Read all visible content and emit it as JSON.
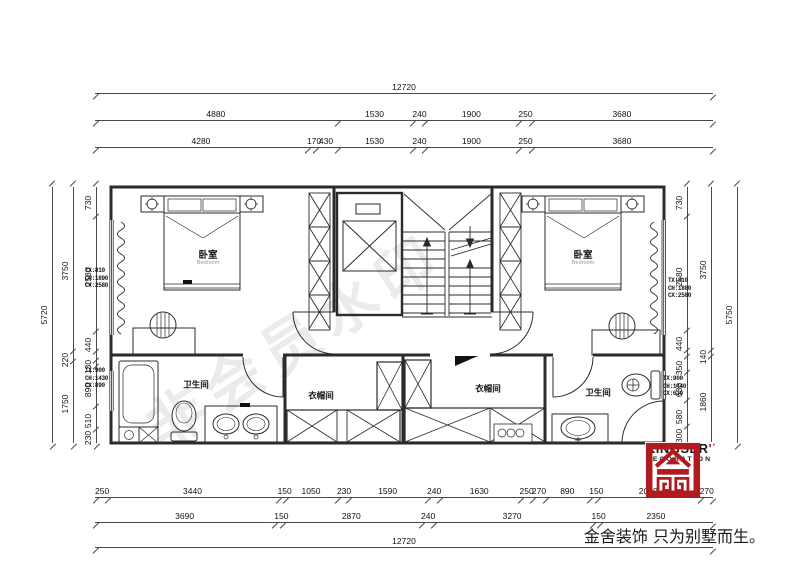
{
  "meta": {
    "watermark": "非会员水印",
    "accent_red": "#b01a20",
    "line_color": "#2b2b2b"
  },
  "brand": {
    "name": "KINGSER",
    "mark": "'",
    "sub": "DECORATION",
    "slogan": "金舍装饰 只为别墅而生。"
  },
  "rooms": {
    "bedroom_left": {
      "name": "卧室",
      "en": "Bedroom"
    },
    "bedroom_right": {
      "name": "卧室",
      "en": "Bedroom"
    },
    "bath_left": {
      "name": "卫生间"
    },
    "bath_right": {
      "name": "卫生间"
    },
    "closet_left": {
      "name": "衣帽间"
    },
    "closet_right": {
      "name": "衣帽间"
    }
  },
  "window_notes": {
    "left_top": [
      "TX:810",
      "CH:1890",
      "CX:2580"
    ],
    "left_bottom": [
      "TX:900",
      "CH:1430",
      "CX:890"
    ],
    "right_top": [
      "TX:810",
      "CH:1880",
      "CX:2580"
    ],
    "right_bottom": [
      "TX:900",
      "CH:1440",
      "CX:630"
    ]
  },
  "dimensions": {
    "top_overall": [
      {
        "v": 12720,
        "t": "12720"
      }
    ],
    "top_mid": [
      {
        "v": 4880,
        "t": "4880"
      },
      {
        "v": 1530,
        "t": "1530"
      },
      {
        "v": 240,
        "t": "240"
      },
      {
        "v": 1900,
        "t": "1900"
      },
      {
        "v": 250,
        "t": "250"
      },
      {
        "v": 3680,
        "t": "3680"
      }
    ],
    "top_inner": [
      {
        "v": 4280,
        "t": "4280"
      },
      {
        "v": 170,
        "t": "170"
      },
      {
        "v": 430,
        "t": "430"
      },
      {
        "v": 1530,
        "t": "1530"
      },
      {
        "v": 240,
        "t": "240"
      },
      {
        "v": 1900,
        "t": "1900"
      },
      {
        "v": 250,
        "t": "250"
      },
      {
        "v": 3680,
        "t": "3680"
      }
    ],
    "bottom_inner": [
      {
        "v": 250,
        "t": "250"
      },
      {
        "v": 3440,
        "t": "3440"
      },
      {
        "v": 150,
        "t": "150"
      },
      {
        "v": 1050,
        "t": "1050"
      },
      {
        "v": 230,
        "t": "230"
      },
      {
        "v": 1590,
        "t": "1590"
      },
      {
        "v": 240,
        "t": "240"
      },
      {
        "v": 1630,
        "t": "1630"
      },
      {
        "v": 250,
        "t": "250"
      },
      {
        "v": 270,
        "t": "270"
      },
      {
        "v": 890,
        "t": "890"
      },
      {
        "v": 150,
        "t": "150"
      },
      {
        "v": 2080,
        "t": "2080"
      },
      {
        "v": 270,
        "t": "270"
      }
    ],
    "bottom_mid": [
      {
        "v": 3690,
        "t": "3690"
      },
      {
        "v": 150,
        "t": "150"
      },
      {
        "v": 2870,
        "t": "2870"
      },
      {
        "v": 240,
        "t": "240"
      },
      {
        "v": 3270,
        "t": "3270"
      },
      {
        "v": 150,
        "t": "150"
      },
      {
        "v": 2350,
        "t": "2350"
      }
    ],
    "bottom_overall": [
      {
        "v": 12720,
        "t": "12720"
      }
    ],
    "left_overall": [
      {
        "v": 5720,
        "t": "5720"
      }
    ],
    "left_mid": [
      {
        "v": 3750,
        "t": "3750"
      },
      {
        "v": 220,
        "t": "220"
      },
      {
        "v": 1750,
        "t": "1750"
      }
    ],
    "left_inner": [
      {
        "v": 730,
        "t": "730"
      },
      {
        "v": 2580,
        "t": "2580"
      },
      {
        "v": 440,
        "t": "440"
      },
      {
        "v": 220,
        "t": ""
      },
      {
        "v": 130,
        "t": "130"
      },
      {
        "v": 890,
        "t": "890"
      },
      {
        "v": 510,
        "t": "510"
      },
      {
        "v": 230,
        "t": "230"
      }
    ],
    "right_inner": [
      {
        "v": 730,
        "t": "730"
      },
      {
        "v": 2580,
        "t": "2580"
      },
      {
        "v": 440,
        "t": "440"
      },
      {
        "v": 140,
        "t": ""
      },
      {
        "v": 350,
        "t": "350"
      },
      {
        "v": 630,
        "t": "630"
      },
      {
        "v": 580,
        "t": "580"
      },
      {
        "v": 300,
        "t": "300"
      }
    ],
    "right_mid": [
      {
        "v": 3750,
        "t": "3750"
      },
      {
        "v": 140,
        "t": "140"
      },
      {
        "v": 1860,
        "t": "1860"
      }
    ],
    "right_overall": [
      {
        "v": 5750,
        "t": "5750"
      }
    ]
  }
}
